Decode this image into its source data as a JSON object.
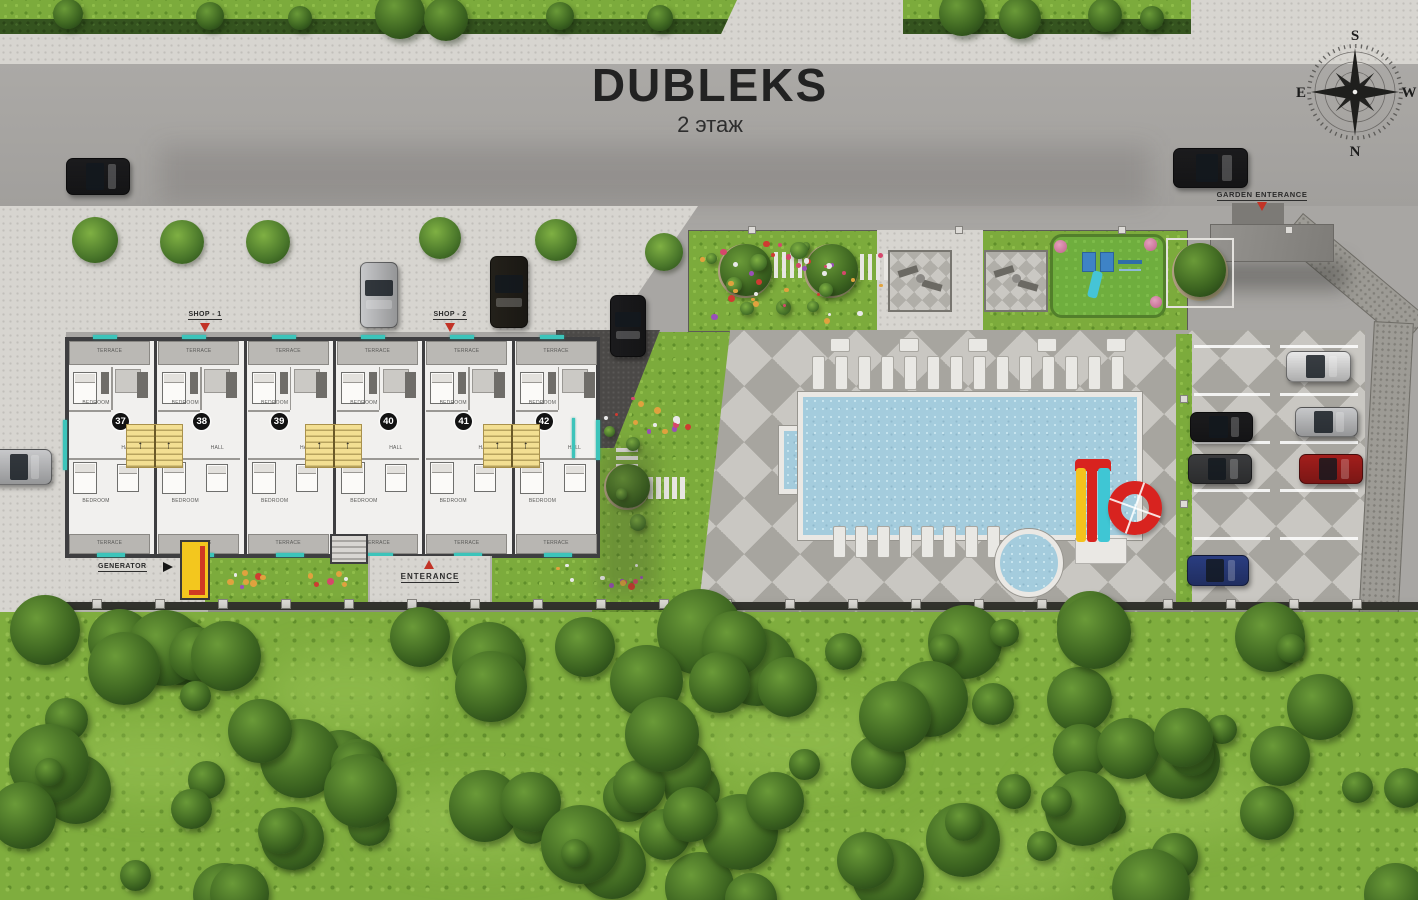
{
  "title": {
    "main": "DUBLEKS",
    "subtitle": "2 этаж"
  },
  "compass": {
    "top": "S",
    "left": "E",
    "right": "W",
    "bottom": "N"
  },
  "labels": {
    "shop1": "SHOP - 1",
    "shop2": "SHOP - 2",
    "generator": "GENERATOR",
    "entrance": "ENTERANCE",
    "garden_entrance": "GARDEN ENTERANCE"
  },
  "units": [
    {
      "number": "37"
    },
    {
      "number": "38"
    },
    {
      "number": "39"
    },
    {
      "number": "40"
    },
    {
      "number": "41"
    },
    {
      "number": "42"
    }
  ],
  "room_labels": {
    "terrace": "TERRACE",
    "bedroom": "BEDROOM",
    "hall": "HALL"
  },
  "colors": {
    "accent_teal": "#3cc4ba",
    "stair_yellow": "#f3df92",
    "slide_red": "#d8231f",
    "slide_yellow": "#f4c21d",
    "slide_cyan": "#3fc6d4",
    "pool_water": "#a4ccdd",
    "lawn_green": "#7cab3c",
    "generator_yellow": "#f3c71e",
    "road_gray": "#a8a6a3"
  },
  "vehicle_colors": {
    "black": "#1b1b1d",
    "dark_brown": "#23201a",
    "silver": "#c7c8ca",
    "white": "#e8e8e8",
    "dark_gray": "#3a3b3d",
    "red": "#a31e1c",
    "blue": "#2a3d80"
  }
}
